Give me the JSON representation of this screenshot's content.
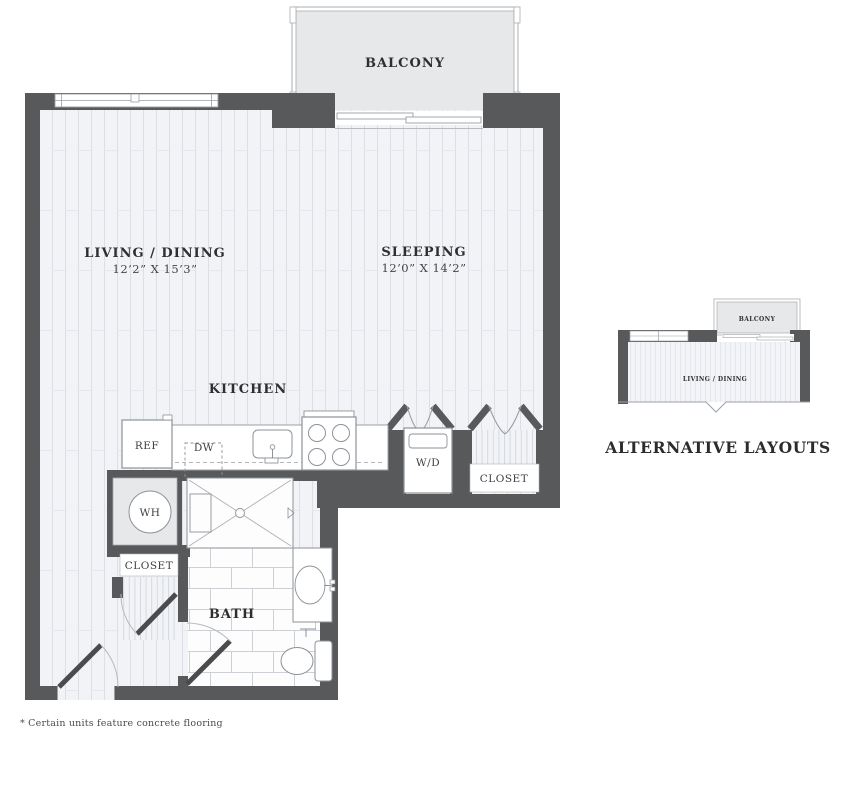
{
  "plan": {
    "balcony_label": "BALCONY",
    "living": {
      "name": "LIVING / DINING",
      "dims": "12’2” X 15’3”"
    },
    "sleeping": {
      "name": "SLEEPING",
      "dims": "12’0” X 14’2”"
    },
    "kitchen_label": "KITCHEN",
    "bath_label": "BATH",
    "ref_label": "REF",
    "dw_label": "DW",
    "wd_label": "W/D",
    "closet_right_label": "CLOSET",
    "wh_label": "WH",
    "closet_left_label": "CLOSET"
  },
  "alternative": {
    "heading": "ALTERNATIVE LAYOUTS",
    "balcony_label": "BALCONY",
    "living_label": "LIVING / DINING"
  },
  "footnote": "* Certain units feature concrete flooring",
  "colors": {
    "wall": "#58595b",
    "floor": "#f2f3f6",
    "plank_line": "#dcdfe4",
    "balcony_fill": "#e6e8ea",
    "fixture_line": "#8d9298",
    "tile_line": "#cdd1d6",
    "text": "#2e2f31"
  }
}
